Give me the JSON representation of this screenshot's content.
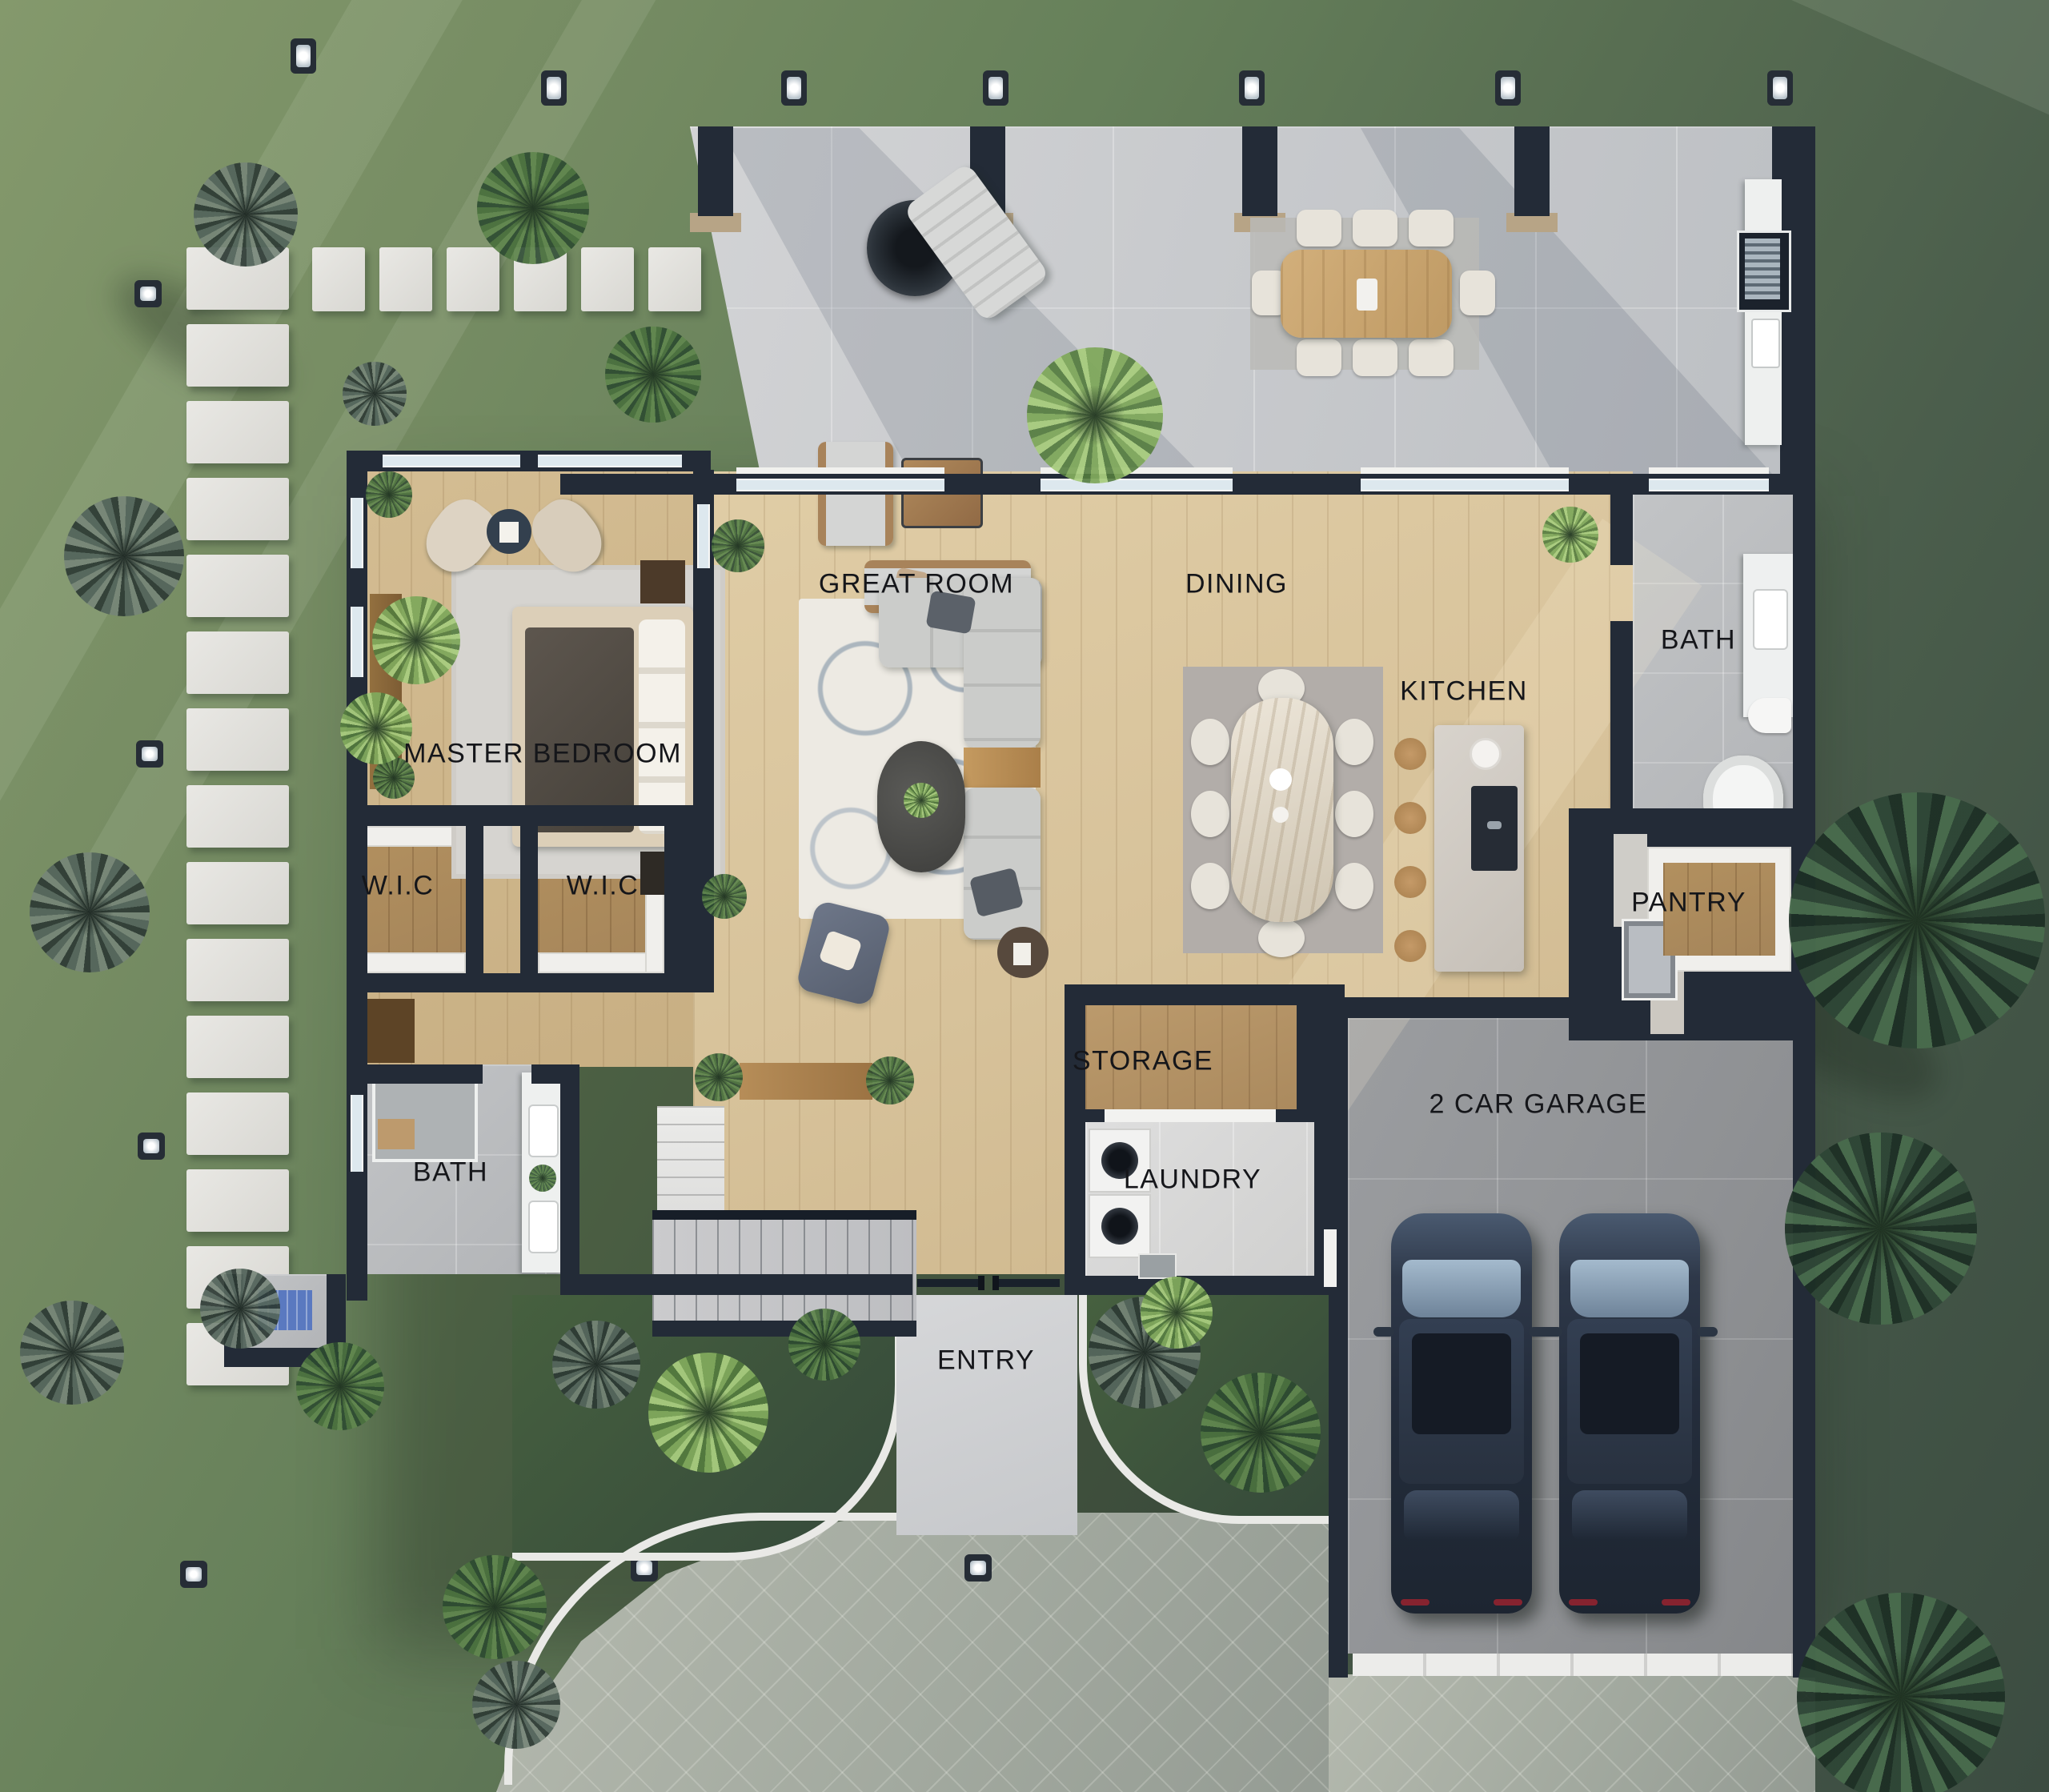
{
  "labels": {
    "great_room": "GREAT ROOM",
    "dining": "DINING",
    "kitchen": "KITCHEN",
    "bath_upper": "BATH",
    "master_bedroom": "MASTER BEDROOM",
    "wic_left": "W.I.C",
    "wic_right": "W.I.C",
    "pantry": "PANTRY",
    "storage": "STORAGE",
    "laundry": "LAUNDRY",
    "bath_lower": "BATH",
    "entry": "ENTRY",
    "garage": "2 CAR GARAGE"
  },
  "colors": {
    "wall": "#232b37",
    "wood_floor": "#d7c29a",
    "closet_wood": "#a5855a",
    "tile": "#b9bcbe",
    "patio_concrete": "#c8cacd",
    "grass_light": "#84996c",
    "grass_dark": "#3c4c41",
    "driveway_pavers": "#a2a99f",
    "stepping_stone": "#e3e2de",
    "car_body": "#2e3849",
    "label_text": "#15161a",
    "bath_mat_blue": "#5a79c0"
  }
}
